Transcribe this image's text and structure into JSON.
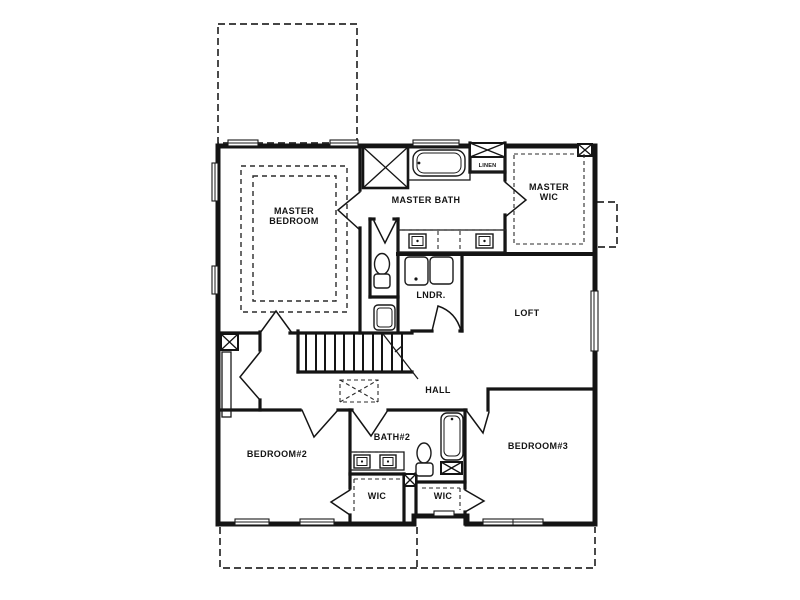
{
  "page": {
    "background": "#ffffff",
    "ink_color": "#141414",
    "dash_color": "#2b2b2b"
  },
  "plan": {
    "type": "second-floor-plan",
    "rooms": [
      {
        "id": "master-bedroom",
        "label": "MASTER BEDROOM",
        "lines": [
          "MASTER",
          "BEDROOM"
        ]
      },
      {
        "id": "master-bath",
        "label": "MASTER BATH",
        "lines": [
          "MASTER BATH"
        ]
      },
      {
        "id": "linen",
        "label": "LINEN",
        "lines": [
          "LINEN"
        ]
      },
      {
        "id": "master-wic",
        "label": "MASTER WIC",
        "lines": [
          "MASTER",
          "WIC"
        ]
      },
      {
        "id": "laundry",
        "label": "LNDR.",
        "lines": [
          "LNDR."
        ]
      },
      {
        "id": "loft",
        "label": "LOFT",
        "lines": [
          "LOFT"
        ]
      },
      {
        "id": "hall",
        "label": "HALL",
        "lines": [
          "HALL"
        ]
      },
      {
        "id": "bedroom-2",
        "label": "BEDROOM#2",
        "lines": [
          "BEDROOM#2"
        ]
      },
      {
        "id": "bath-2",
        "label": "BATH#2",
        "lines": [
          "BATH#2"
        ]
      },
      {
        "id": "bedroom-3",
        "label": "BEDROOM#3",
        "lines": [
          "BEDROOM#3"
        ]
      },
      {
        "id": "wic-left",
        "label": "WIC",
        "lines": [
          "WIC"
        ]
      },
      {
        "id": "wic-right",
        "label": "WIC",
        "lines": [
          "WIC"
        ]
      }
    ],
    "fixture_icons": [
      "shower-icon",
      "garden-tub-icon",
      "bathtub-icon",
      "toilet-icon",
      "double-vanity-icon",
      "washer-dryer-icon",
      "utility-sink-icon",
      "stairs-icon",
      "attic-access-icon",
      "chase-x-icon"
    ]
  }
}
